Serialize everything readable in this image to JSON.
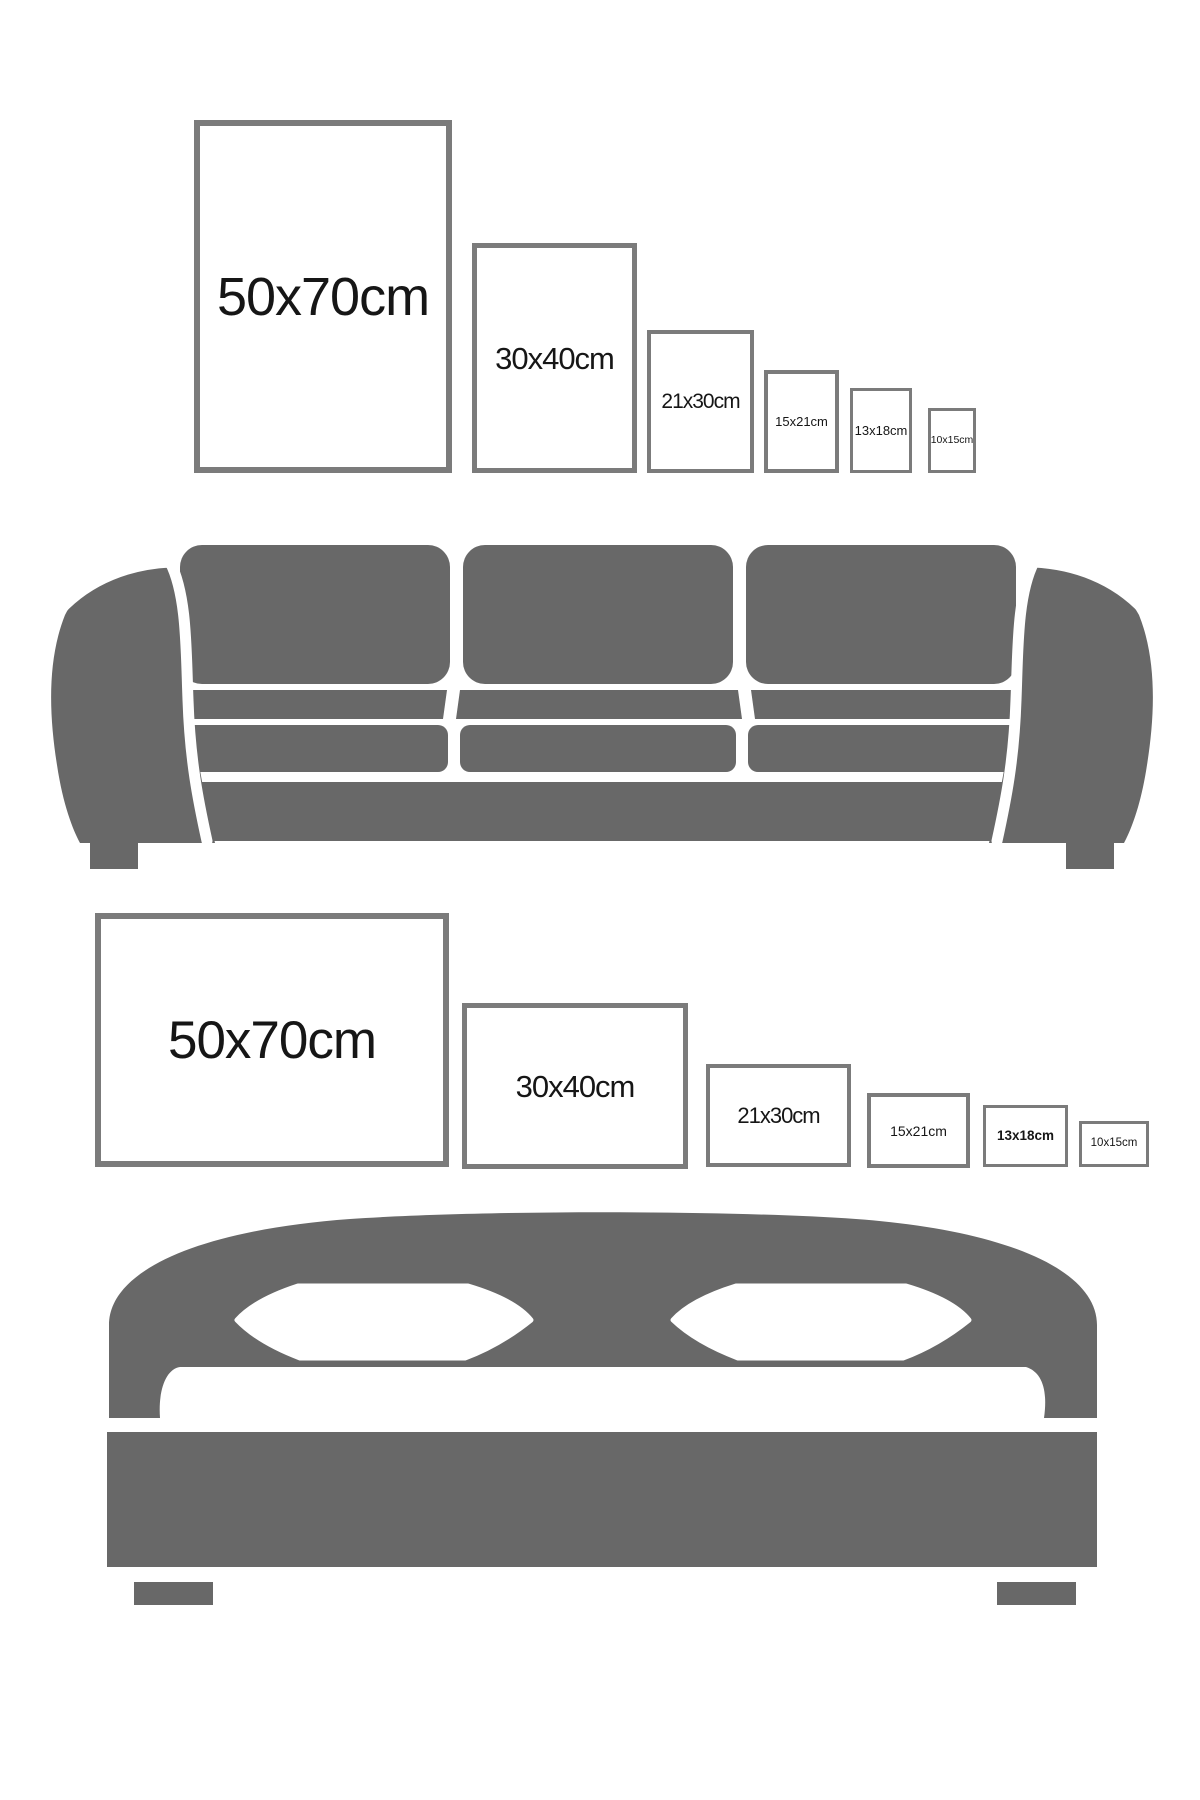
{
  "colors": {
    "background": "#ffffff",
    "furniture_gray": "#686868",
    "frame_border": "#7b7b7b",
    "label_text": "#161616"
  },
  "sofa_section": {
    "illustration": "three-seat sofa silhouette",
    "frames": [
      {
        "label": "50x70cm",
        "orientation": "portrait"
      },
      {
        "label": "30x40cm",
        "orientation": "portrait"
      },
      {
        "label": "21x30cm",
        "orientation": "portrait"
      },
      {
        "label": "15x21cm",
        "orientation": "portrait"
      },
      {
        "label": "13x18cm",
        "orientation": "portrait"
      },
      {
        "label": "10x15cm",
        "orientation": "portrait"
      }
    ]
  },
  "bed_section": {
    "illustration": "double bed silhouette",
    "frames": [
      {
        "label": "50x70cm",
        "orientation": "landscape"
      },
      {
        "label": "30x40cm",
        "orientation": "landscape"
      },
      {
        "label": "21x30cm",
        "orientation": "landscape"
      },
      {
        "label": "15x21cm",
        "orientation": "landscape"
      },
      {
        "label": "13x18cm",
        "orientation": "landscape"
      },
      {
        "label": "10x15cm",
        "orientation": "landscape"
      }
    ]
  }
}
